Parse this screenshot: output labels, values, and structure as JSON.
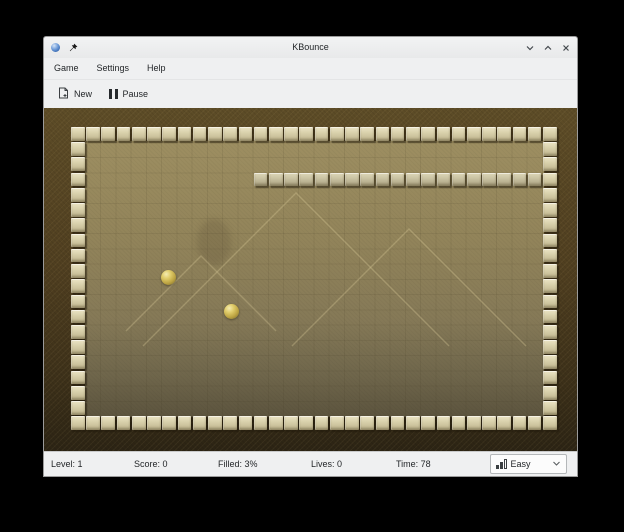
{
  "window": {
    "title": "KBounce"
  },
  "menubar": {
    "items": [
      {
        "label": "Game"
      },
      {
        "label": "Settings"
      },
      {
        "label": "Help"
      }
    ]
  },
  "toolbar": {
    "buttons": [
      {
        "label": "New"
      },
      {
        "label": "Pause"
      }
    ]
  },
  "statusbar": {
    "level": "Level: 1",
    "score": "Score: 0",
    "filled": "Filled: 3%",
    "lives": "Lives: 0",
    "time": "Time: 78",
    "difficulty": {
      "value": "Easy"
    }
  },
  "board": {
    "cols": 32,
    "rows": 20,
    "origin_x": 27,
    "origin_y": 19,
    "pitch": 15.23,
    "tile": 13.6,
    "wall": {
      "row": 3,
      "col_start": 12
    },
    "balls": [
      {
        "x": 124.5,
        "y": 169,
        "d": 15
      },
      {
        "x": 187.5,
        "y": 203.5,
        "d": 15
      }
    ]
  },
  "colors": {
    "frame_brown": "#503f20",
    "field_olive": "#8d7f55",
    "tile_beige": "#d6cfae",
    "ball_gold": "#d3bd5c",
    "chrome_bg": "#eff0f1"
  }
}
